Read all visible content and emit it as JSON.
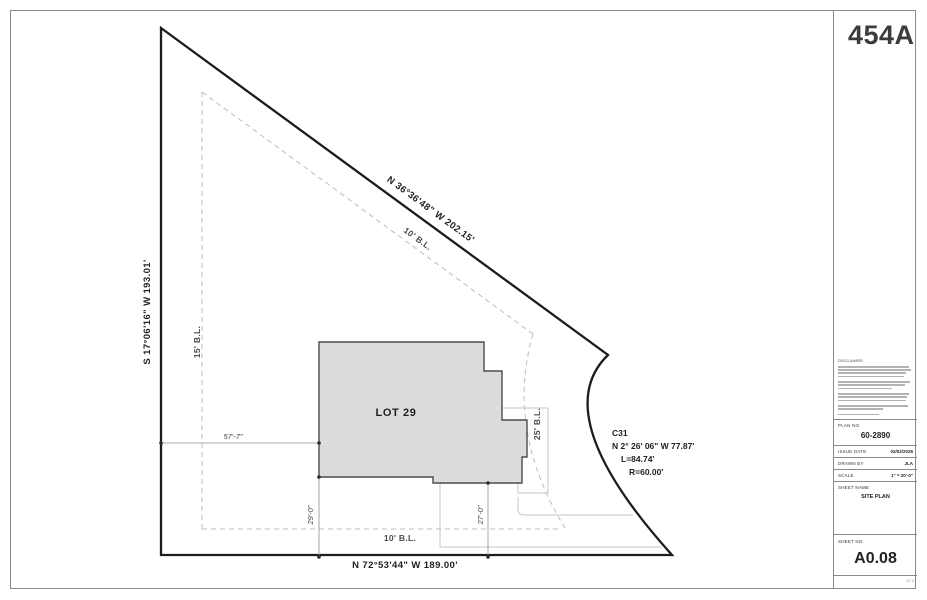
{
  "page": {
    "plan_badge": "454A",
    "version": "V2.0"
  },
  "drawing": {
    "lot_label": "LOT 29",
    "boundary": {
      "left_bearing": "S 17°06'16\" W  193.01'",
      "top_bearing": "N 36°36'48\" W  202.15'",
      "bottom_bearing": "N 72°53'44\" W  189.00'"
    },
    "curve": {
      "id": "C31",
      "bearing": "N 2° 26' 06\" W  77.87'",
      "length": "L=84.74'",
      "radius": "R=60.00'"
    },
    "setbacks": {
      "top": "10' B.L.",
      "left": "15' B.L.",
      "bottom": "10' B.L.",
      "right": "25' B.L."
    },
    "dimensions": {
      "left_width": "57'-7\"",
      "bottom_left": "29'-0\"",
      "bottom_right": "27'-0\""
    }
  },
  "titleblock": {
    "disclaimer_heading": "DISCLAIMER:",
    "plan_no_label": "PLAN NO.",
    "plan_no": "60-2890",
    "rows": [
      {
        "label": "ISSUE DATE",
        "value": "02/02/2026"
      },
      {
        "label": "DRAWN BY",
        "value": "JLA"
      },
      {
        "label": "SCALE",
        "value": "1\" = 20'-0\""
      }
    ],
    "sheet_name_label": "SHEET NAME",
    "sheet_name": "SITE PLAN",
    "sheet_no_label": "SHEET NO.",
    "sheet_no": "A0.08"
  }
}
